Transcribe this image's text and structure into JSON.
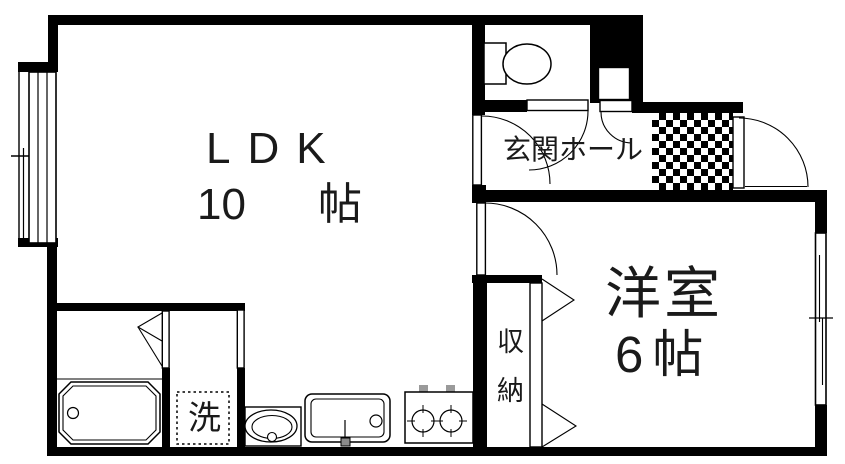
{
  "plan": {
    "rooms": {
      "ldk": {
        "name": "LDK",
        "size_value": "10",
        "size_unit": "帖"
      },
      "entrance_hall": {
        "name": "玄関ホール"
      },
      "western_room": {
        "name": "洋室",
        "size": "6帖"
      },
      "closet": {
        "name": "収納"
      },
      "laundry": {
        "mark": "洗"
      }
    },
    "fixture_icons": [
      "toilet-icon",
      "bathtub-icon",
      "washbasin-icon",
      "kitchen-sink-icon",
      "gas-stove-icon",
      "washing-machine-pan-icon",
      "entrance-door-swing-icon",
      "interior-door-swing-icon",
      "bifold-door-icon",
      "sliding-window-icon",
      "pipe-shaft-icon",
      "doma-checker-floor"
    ],
    "colors": {
      "wall": "#000000",
      "background": "#ffffff",
      "stove_knob": "#9a9a9a"
    }
  }
}
